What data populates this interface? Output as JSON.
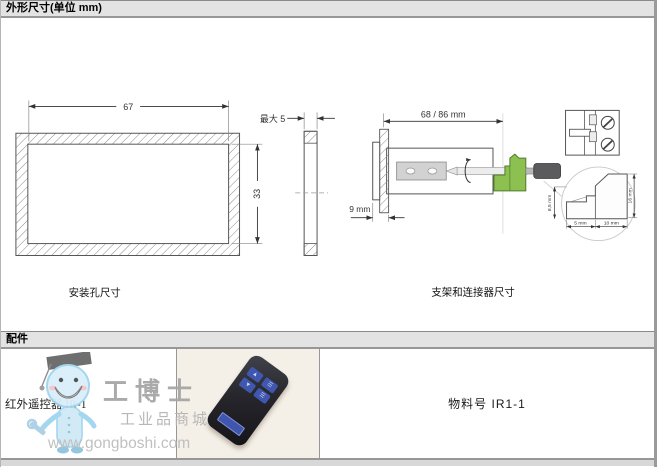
{
  "dimensions_section": {
    "title": "外形尺寸(单位 mm)",
    "mounting_hole": {
      "caption": "安装孔尺寸",
      "width": "67",
      "height": "33",
      "max_panel_thickness": "最大 5"
    },
    "bracket": {
      "caption": "支架和连接器尺寸",
      "length": "68 / 86 mm",
      "depth": "9 mm"
    },
    "connector_detail": {
      "dim_height_left": "8,5 mm",
      "dim_height_right": "16 mm",
      "dim_width_left": "5 mm",
      "dim_width_right": "10 mm"
    }
  },
  "accessories_section": {
    "title": "配件",
    "item": {
      "name": "红外遥控器 IR-1",
      "part_number": "物料号 IR1-1"
    }
  },
  "watermark": {
    "brand": "工博士",
    "subtitle": "工业品商城",
    "url": "www.gongboshi.com"
  },
  "colors": {
    "section_bar_bg": "#e3e3e3",
    "connector_green": "#8cc152",
    "remote_button_blue": "#3f57ae",
    "photo_bg": "#f4efe7",
    "watermark_blue": "#cfe9f6"
  }
}
